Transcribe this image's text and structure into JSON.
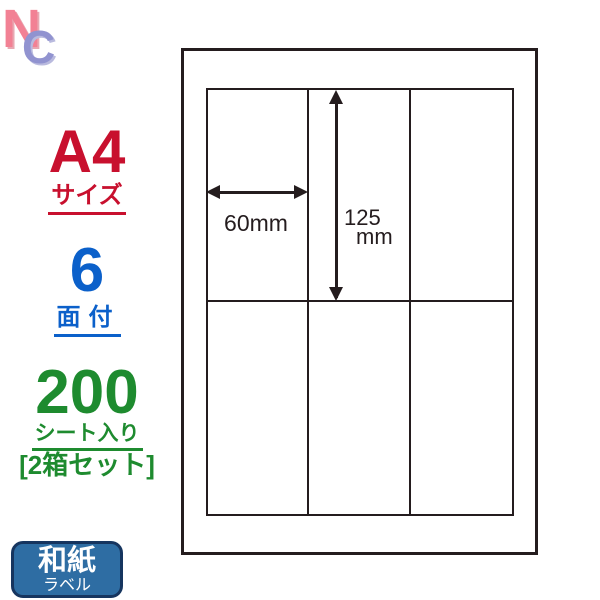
{
  "logo": {
    "n": "N",
    "c": "C"
  },
  "left_panel": {
    "size": {
      "value": "A4",
      "label": "サイズ"
    },
    "faces": {
      "value": "6",
      "label": "面付"
    },
    "sheets": {
      "value": "200",
      "label": "シート入り",
      "set_label": "[2箱セット]"
    }
  },
  "badge": {
    "title": "和紙",
    "subtitle": "ラベル"
  },
  "diagram": {
    "columns": 3,
    "rows": 2,
    "width_dimension": "60mm",
    "height_dimension_value": "125",
    "height_dimension_unit": "mm"
  },
  "colors": {
    "size_red": "#c8102e",
    "faces_blue": "#0b60ca",
    "sheets_green": "#1e8b2f",
    "badge_fill": "#2e6da3",
    "badge_border": "#16355f",
    "diagram_line": "#241c1e",
    "logo_pink": "#f28194",
    "logo_periwinkle": "#9193d0"
  }
}
